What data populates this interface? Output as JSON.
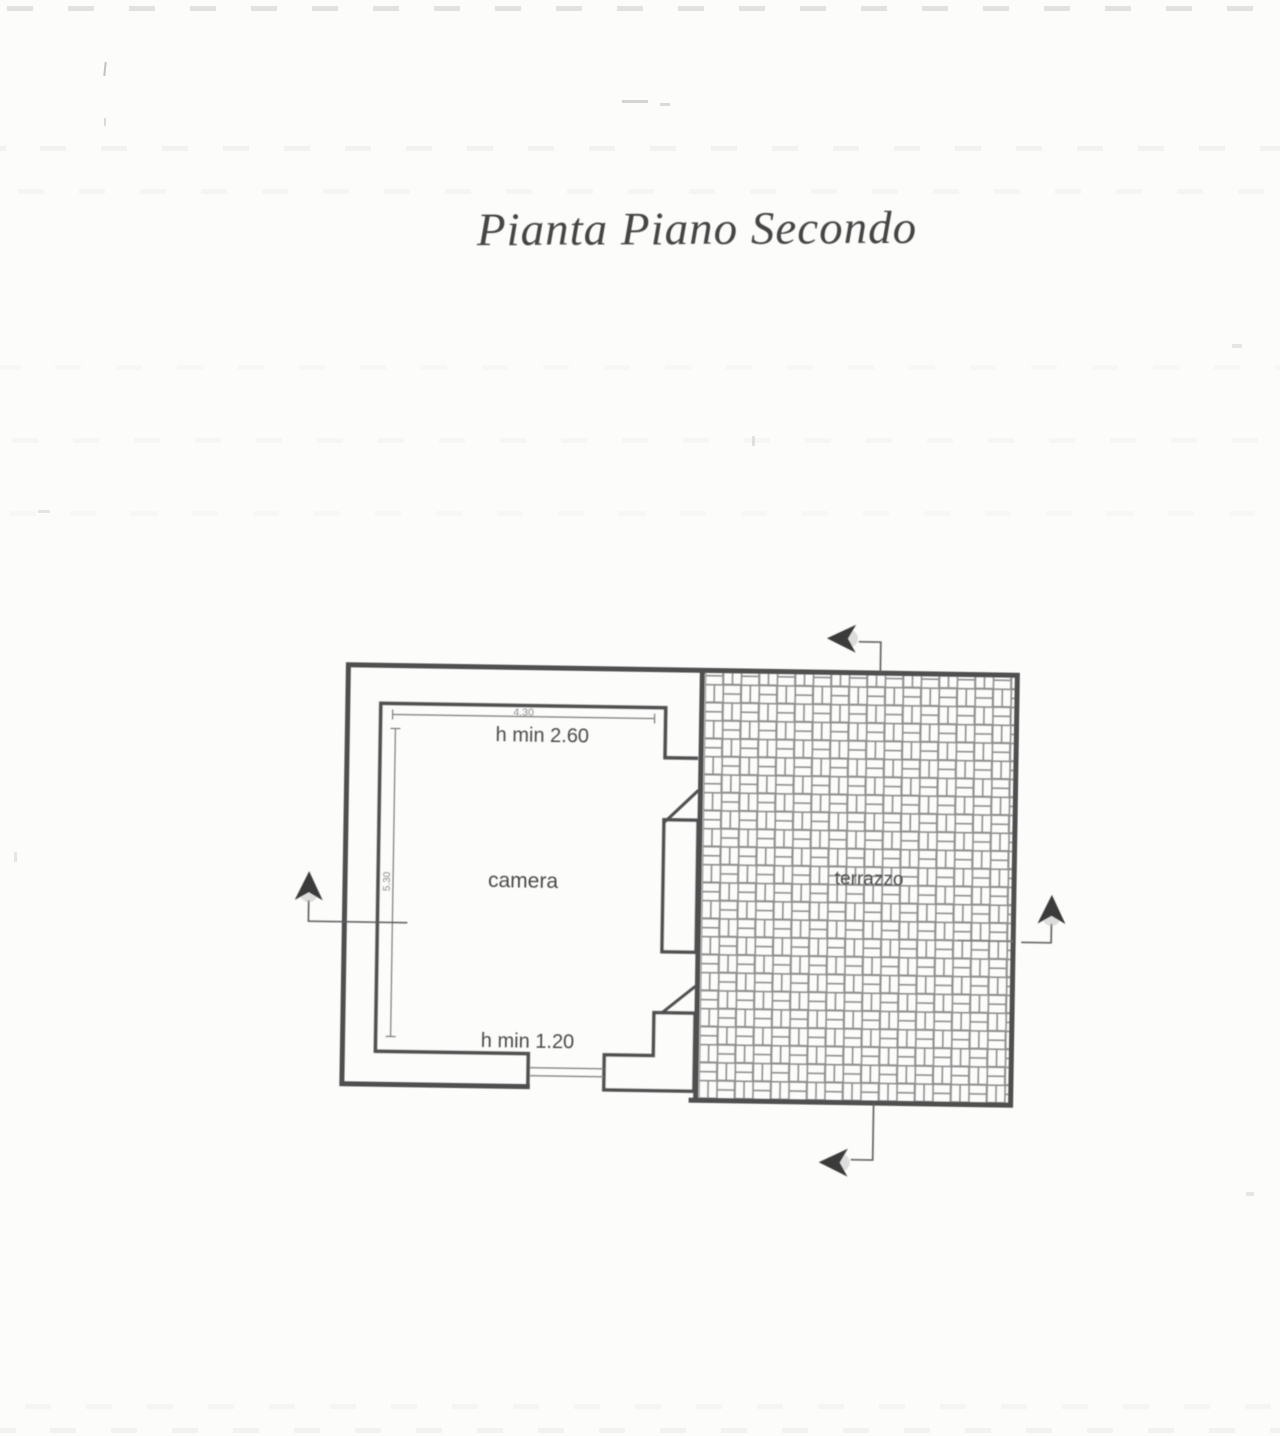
{
  "title": "Pianta Piano Secondo",
  "plan": {
    "room": {
      "label": "camera",
      "height_note_top": "h min 2.60",
      "height_note_bottom": "h min 1.20",
      "width_dim": "4.30",
      "depth_dim": "5.30"
    },
    "terrace": {
      "label": "terrazzo"
    },
    "markers": {
      "top": "section-arrow-left",
      "bottom": "section-arrow-left",
      "left": "section-arrow-up",
      "right": "section-arrow-up"
    },
    "colors": {
      "wall_line": "#4f4f4f",
      "thin_line": "#7a7a7a",
      "hatch_line": "#8f8f8f",
      "label_text": "#4a4a4a",
      "small_text": "#6e6e6e",
      "title_text": "#454545",
      "arrow_fill": "#3a3a3a",
      "paper": "#fcfcfb"
    }
  }
}
